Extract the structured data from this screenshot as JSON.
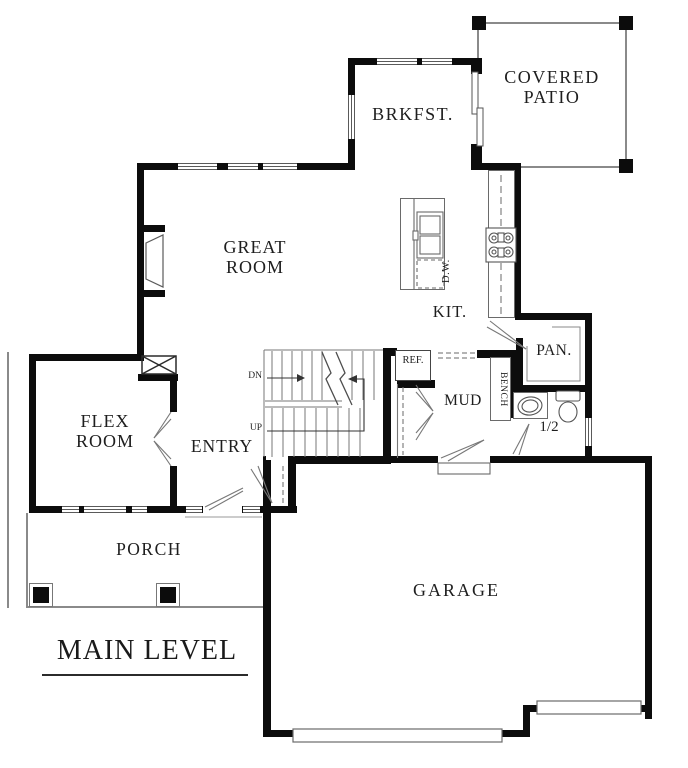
{
  "title": {
    "text": "MAIN LEVEL"
  },
  "rooms": {
    "covered_patio": {
      "label": "COVERED\nPATIO"
    },
    "brkfst": {
      "label": "BRKFST."
    },
    "great_room": {
      "label": "GREAT\nROOM"
    },
    "kitchen": {
      "label": "KIT."
    },
    "pantry": {
      "label": "PAN."
    },
    "mud": {
      "label": "MUD"
    },
    "half_bath": {
      "label": "1/2"
    },
    "flex_room": {
      "label": "FLEX\nROOM"
    },
    "entry": {
      "label": "ENTRY"
    },
    "porch": {
      "label": "PORCH"
    },
    "garage": {
      "label": "GARAGE"
    }
  },
  "fixtures": {
    "refrigerator": "REF.",
    "dishwasher": "D.W.",
    "bench": "BENCH"
  },
  "stairs": {
    "down_label": "DN",
    "up_label": "UP"
  },
  "colors": {
    "wall": "#0c0c0c",
    "thin_line": "#8a8a8a",
    "text": "#1e1e1e",
    "background": "#ffffff"
  }
}
